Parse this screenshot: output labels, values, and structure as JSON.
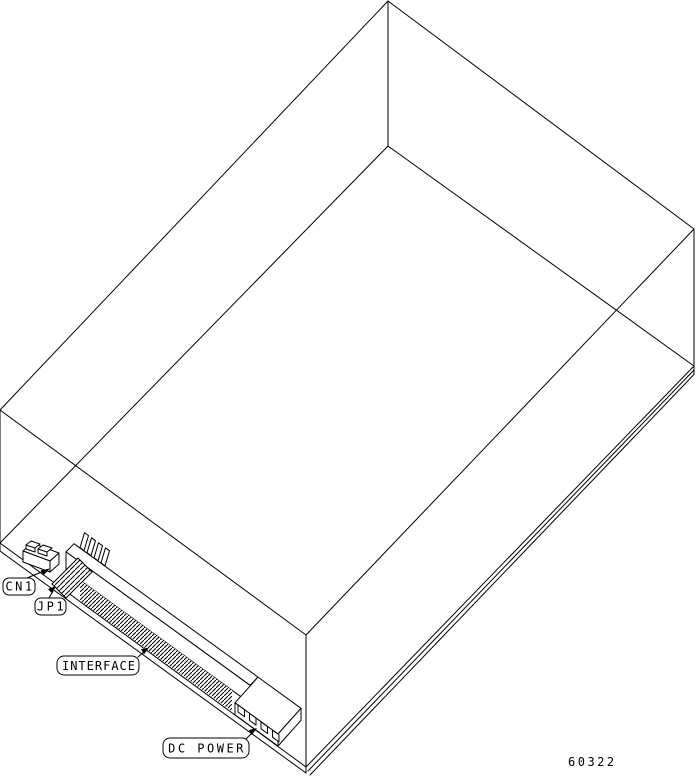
{
  "figure": {
    "number": "60322",
    "description": "Isometric wireframe line drawing of a hard disk drive showing connector locations on the bottom edge"
  },
  "connector_labels": {
    "cn1": "CN1",
    "jp1": "JP1",
    "interface": "INTERFACE",
    "dc_power": "DC POWER"
  },
  "colors": {
    "line": "#000000",
    "background": "#ffffff"
  }
}
